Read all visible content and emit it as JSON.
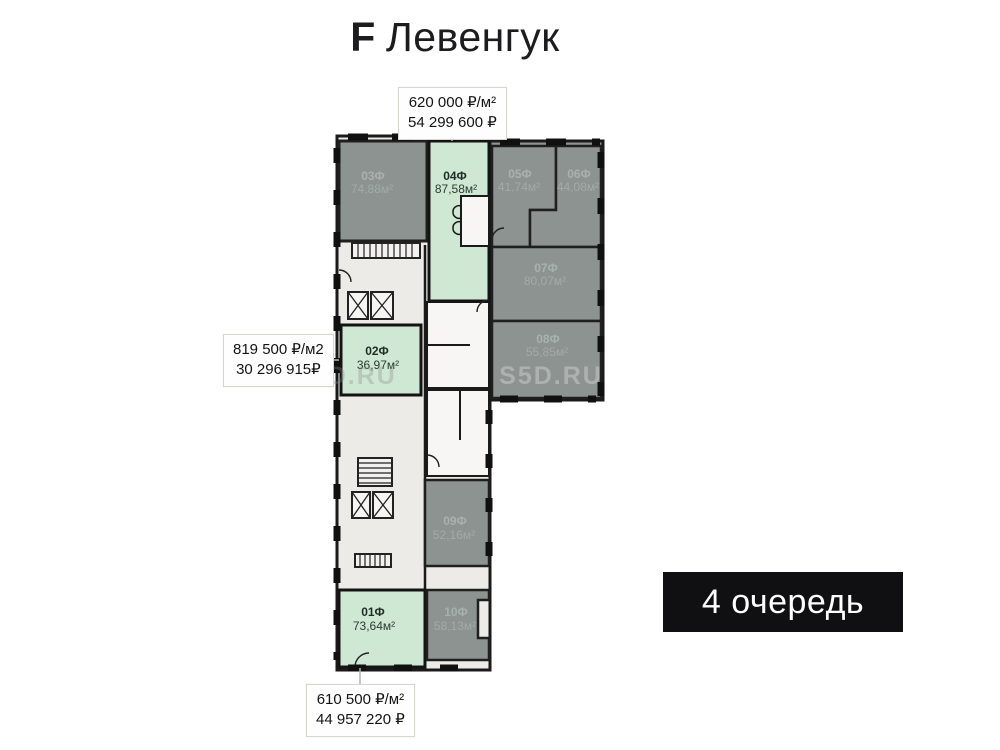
{
  "title": {
    "letter": "F",
    "name": "Левенгук"
  },
  "banner": {
    "label": "4 очередь"
  },
  "watermark": "S5D.RU",
  "callouts": {
    "top": {
      "line1": "620 000 ₽/м²",
      "line2": "54 299 600 ₽"
    },
    "left": {
      "line1": "819 500 ₽/м2",
      "line2": "30 296 915₽"
    },
    "bottom": {
      "line1": "610 500 ₽/м²",
      "line2": "44 957 220 ₽"
    }
  },
  "apartments": [
    {
      "id": "01Ф",
      "area": "73,64м²",
      "highlighted": true
    },
    {
      "id": "02Ф",
      "area": "36,97м²",
      "highlighted": true
    },
    {
      "id": "03Ф",
      "area": "74,88м²",
      "highlighted": false
    },
    {
      "id": "04Ф",
      "area": "87,58м²",
      "highlighted": true
    },
    {
      "id": "05Ф",
      "area": "41,74м²",
      "highlighted": false
    },
    {
      "id": "06Ф",
      "area": "44,08м²",
      "highlighted": false
    },
    {
      "id": "07Ф",
      "area": "80,07м²",
      "highlighted": false
    },
    {
      "id": "08Ф",
      "area": "55,85м²",
      "highlighted": false
    },
    {
      "id": "09Ф",
      "area": "52,16м²",
      "highlighted": false
    },
    {
      "id": "10Ф",
      "area": "58,13м²",
      "highlighted": false
    }
  ],
  "colors": {
    "highlighted_fill": "#cfe8d3",
    "regular_fill": "#8d9391",
    "corridor_fill": "#ecebe7",
    "wall": "#1a1a1a",
    "banner_bg": "#101012"
  }
}
